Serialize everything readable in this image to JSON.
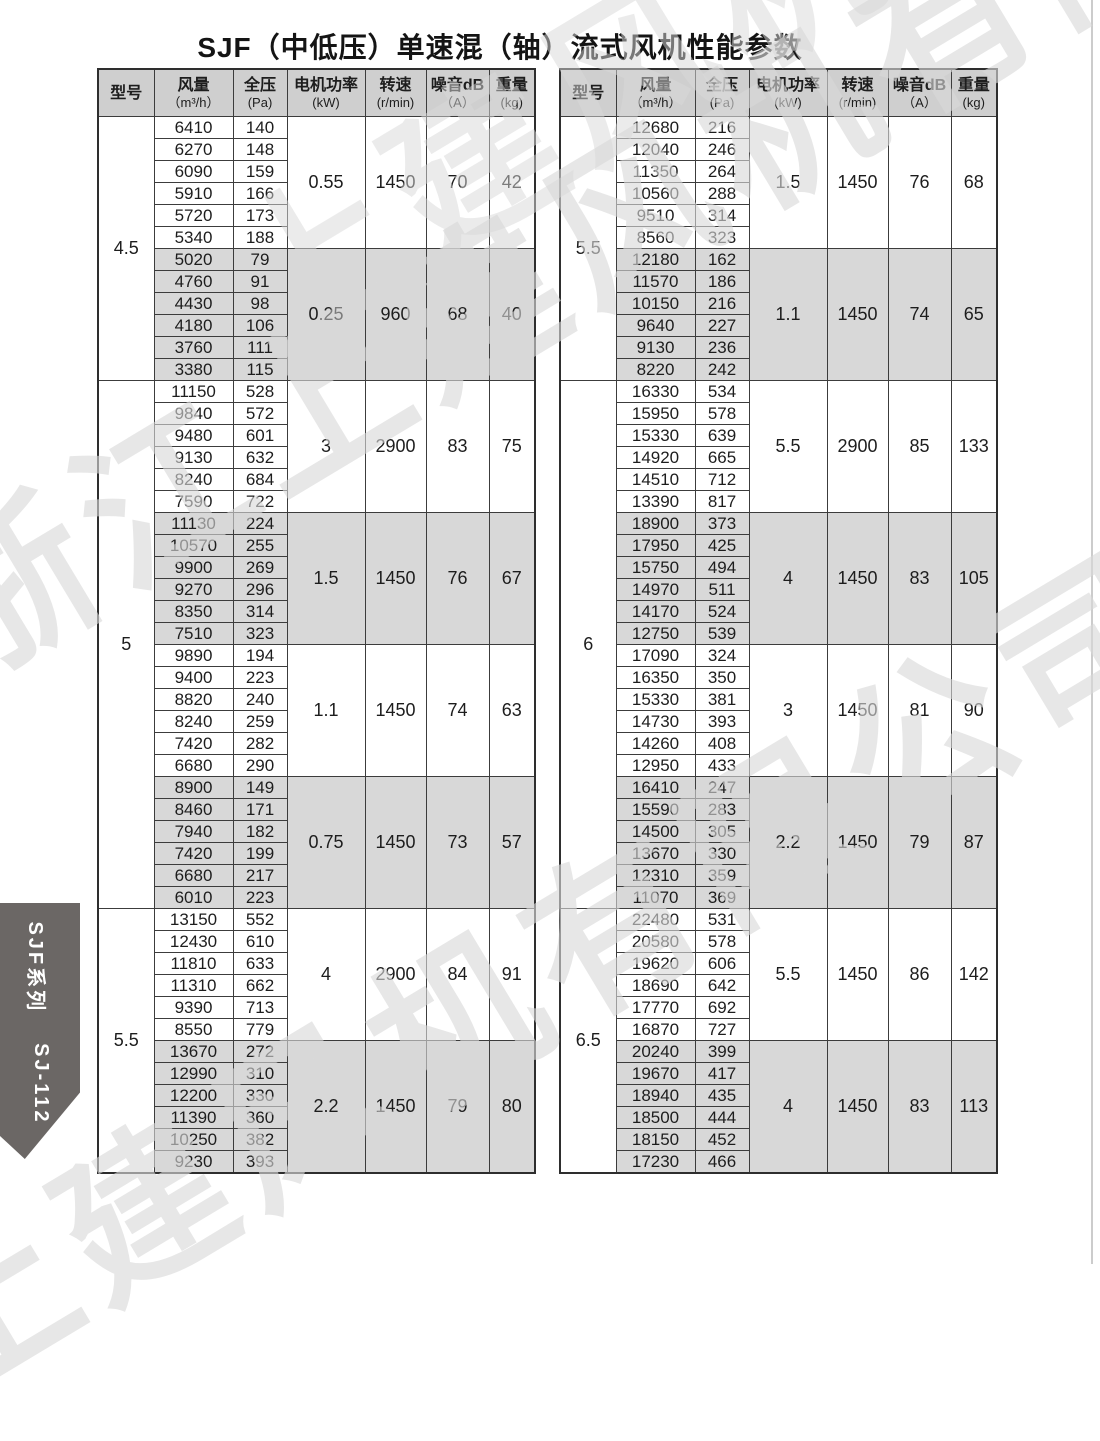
{
  "page": {
    "title": "SJF（中低压）单速混（轴）流式风机性能参数",
    "watermark_full": "浙江上建风机有限公司",
    "watermark_short": "上建风机有限公司",
    "side_tab_series": "SJF系列",
    "side_tab_model": "SJ-112"
  },
  "colors": {
    "header_bg": "#cfcfcf",
    "group_shaded_bg": "#d8d8d8",
    "border": "#3c3c3c",
    "side_tab_bg": "#6b6765",
    "watermark": "#d9d9d9"
  },
  "table_headers": [
    {
      "t": "型号",
      "u": ""
    },
    {
      "t": "风量",
      "u": "（m³/h）"
    },
    {
      "t": "全压",
      "u": "(Pa)"
    },
    {
      "t": "电机功率",
      "u": "(kW)"
    },
    {
      "t": "转速",
      "u": "(r/min)"
    },
    {
      "t": "噪音dB",
      "u": "（A）"
    },
    {
      "t": "重量",
      "u": "(kg)"
    }
  ],
  "tables": [
    {
      "name": "left-performance-table",
      "models": [
        {
          "model": "4.5",
          "groups": [
            {
              "shaded": false,
              "power": "0.55",
              "speed": "1450",
              "noise": "70",
              "weight": "42",
              "rows": [
                [
                  6410,
                  140
                ],
                [
                  6270,
                  148
                ],
                [
                  6090,
                  159
                ],
                [
                  5910,
                  166
                ],
                [
                  5720,
                  173
                ],
                [
                  5340,
                  188
                ]
              ]
            },
            {
              "shaded": true,
              "power": "0.25",
              "speed": "960",
              "noise": "68",
              "weight": "40",
              "rows": [
                [
                  5020,
                  79
                ],
                [
                  4760,
                  91
                ],
                [
                  4430,
                  98
                ],
                [
                  4180,
                  106
                ],
                [
                  3760,
                  111
                ],
                [
                  3380,
                  115
                ]
              ]
            }
          ]
        },
        {
          "model": "5",
          "groups": [
            {
              "shaded": false,
              "power": "3",
              "speed": "2900",
              "noise": "83",
              "weight": "75",
              "rows": [
                [
                  11150,
                  528
                ],
                [
                  9840,
                  572
                ],
                [
                  9480,
                  601
                ],
                [
                  9130,
                  632
                ],
                [
                  8240,
                  684
                ],
                [
                  7590,
                  722
                ]
              ]
            },
            {
              "shaded": true,
              "power": "1.5",
              "speed": "1450",
              "noise": "76",
              "weight": "67",
              "rows": [
                [
                  11130,
                  224
                ],
                [
                  10570,
                  255
                ],
                [
                  9900,
                  269
                ],
                [
                  9270,
                  296
                ],
                [
                  8350,
                  314
                ],
                [
                  7510,
                  323
                ]
              ]
            },
            {
              "shaded": false,
              "power": "1.1",
              "speed": "1450",
              "noise": "74",
              "weight": "63",
              "rows": [
                [
                  9890,
                  194
                ],
                [
                  9400,
                  223
                ],
                [
                  8820,
                  240
                ],
                [
                  8240,
                  259
                ],
                [
                  7420,
                  282
                ],
                [
                  6680,
                  290
                ]
              ]
            },
            {
              "shaded": true,
              "power": "0.75",
              "speed": "1450",
              "noise": "73",
              "weight": "57",
              "rows": [
                [
                  8900,
                  149
                ],
                [
                  8460,
                  171
                ],
                [
                  7940,
                  182
                ],
                [
                  7420,
                  199
                ],
                [
                  6680,
                  217
                ],
                [
                  6010,
                  223
                ]
              ]
            }
          ]
        },
        {
          "model": "5.5",
          "groups": [
            {
              "shaded": false,
              "power": "4",
              "speed": "2900",
              "noise": "84",
              "weight": "91",
              "rows": [
                [
                  13150,
                  552
                ],
                [
                  12430,
                  610
                ],
                [
                  11810,
                  633
                ],
                [
                  11310,
                  662
                ],
                [
                  9390,
                  713
                ],
                [
                  8550,
                  779
                ]
              ]
            },
            {
              "shaded": true,
              "power": "2.2",
              "speed": "1450",
              "noise": "79",
              "weight": "80",
              "rows": [
                [
                  13670,
                  272
                ],
                [
                  12990,
                  310
                ],
                [
                  12200,
                  330
                ],
                [
                  11390,
                  360
                ],
                [
                  10250,
                  382
                ],
                [
                  9230,
                  393
                ]
              ]
            }
          ]
        }
      ]
    },
    {
      "name": "right-performance-table",
      "models": [
        {
          "model": "5.5",
          "groups": [
            {
              "shaded": false,
              "power": "1.5",
              "speed": "1450",
              "noise": "76",
              "weight": "68",
              "rows": [
                [
                  12680,
                  216
                ],
                [
                  12040,
                  246
                ],
                [
                  11350,
                  264
                ],
                [
                  10560,
                  288
                ],
                [
                  9510,
                  314
                ],
                [
                  8560,
                  323
                ]
              ]
            },
            {
              "shaded": true,
              "power": "1.1",
              "speed": "1450",
              "noise": "74",
              "weight": "65",
              "rows": [
                [
                  12180,
                  162
                ],
                [
                  11570,
                  186
                ],
                [
                  10150,
                  216
                ],
                [
                  9640,
                  227
                ],
                [
                  9130,
                  236
                ],
                [
                  8220,
                  242
                ]
              ]
            }
          ]
        },
        {
          "model": "6",
          "groups": [
            {
              "shaded": false,
              "power": "5.5",
              "speed": "2900",
              "noise": "85",
              "weight": "133",
              "rows": [
                [
                  16330,
                  534
                ],
                [
                  15950,
                  578
                ],
                [
                  15330,
                  639
                ],
                [
                  14920,
                  665
                ],
                [
                  14510,
                  712
                ],
                [
                  13390,
                  817
                ]
              ]
            },
            {
              "shaded": true,
              "power": "4",
              "speed": "1450",
              "noise": "83",
              "weight": "105",
              "rows": [
                [
                  18900,
                  373
                ],
                [
                  17950,
                  425
                ],
                [
                  15750,
                  494
                ],
                [
                  14970,
                  511
                ],
                [
                  14170,
                  524
                ],
                [
                  12750,
                  539
                ]
              ]
            },
            {
              "shaded": false,
              "power": "3",
              "speed": "1450",
              "noise": "81",
              "weight": "90",
              "rows": [
                [
                  17090,
                  324
                ],
                [
                  16350,
                  350
                ],
                [
                  15330,
                  381
                ],
                [
                  14730,
                  393
                ],
                [
                  14260,
                  408
                ],
                [
                  12950,
                  433
                ]
              ]
            },
            {
              "shaded": true,
              "power": "2.2",
              "speed": "1450",
              "noise": "79",
              "weight": "87",
              "rows": [
                [
                  16410,
                  247
                ],
                [
                  15590,
                  283
                ],
                [
                  14500,
                  305
                ],
                [
                  13670,
                  330
                ],
                [
                  12310,
                  359
                ],
                [
                  11070,
                  369
                ]
              ]
            }
          ]
        },
        {
          "model": "6.5",
          "groups": [
            {
              "shaded": false,
              "power": "5.5",
              "speed": "1450",
              "noise": "86",
              "weight": "142",
              "rows": [
                [
                  22480,
                  531
                ],
                [
                  20580,
                  578
                ],
                [
                  19620,
                  606
                ],
                [
                  18690,
                  642
                ],
                [
                  17770,
                  692
                ],
                [
                  16870,
                  727
                ]
              ]
            },
            {
              "shaded": true,
              "power": "4",
              "speed": "1450",
              "noise": "83",
              "weight": "113",
              "rows": [
                [
                  20240,
                  399
                ],
                [
                  19670,
                  417
                ],
                [
                  18940,
                  435
                ],
                [
                  18500,
                  444
                ],
                [
                  18150,
                  452
                ],
                [
                  17230,
                  466
                ]
              ]
            }
          ]
        }
      ]
    }
  ]
}
